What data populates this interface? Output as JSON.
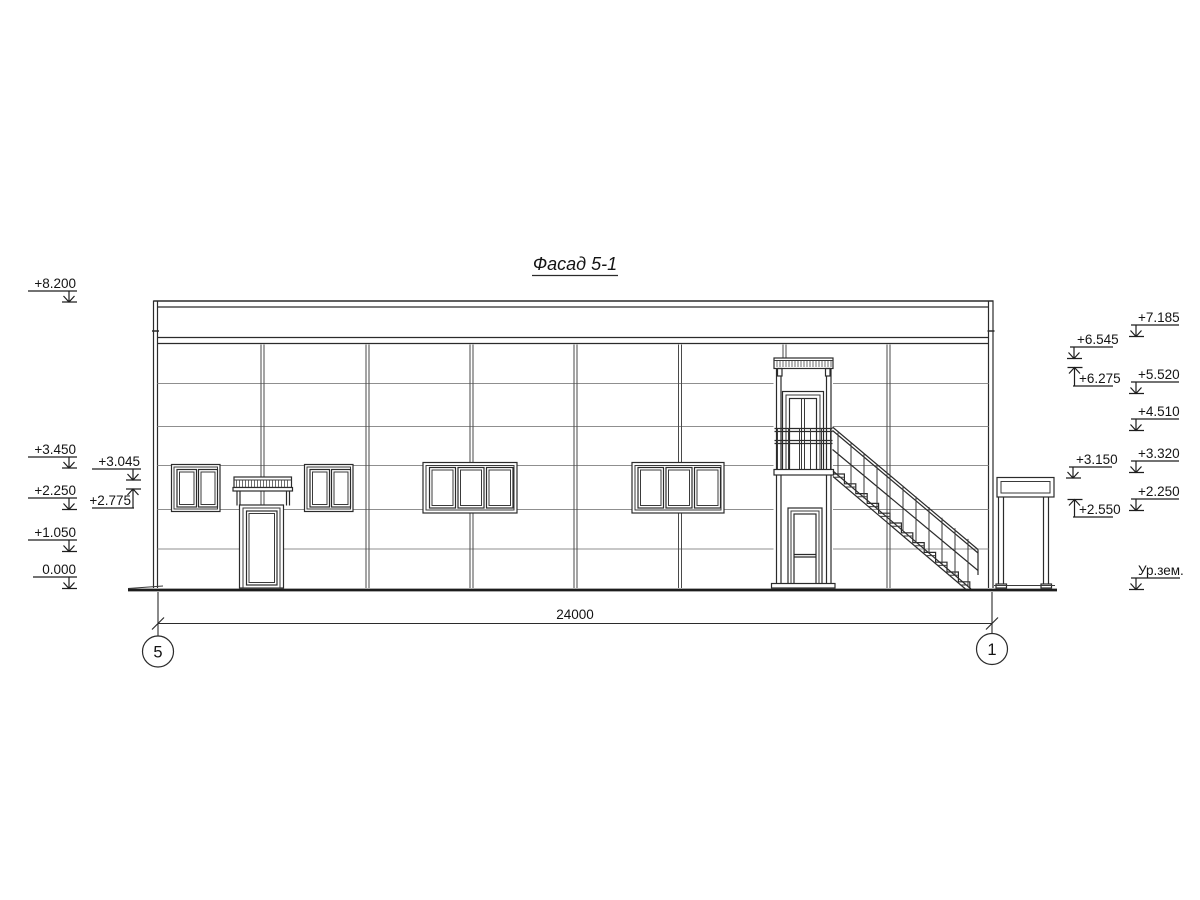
{
  "drawing": {
    "title": "Фасад 5-1",
    "dimension_total": "24000",
    "axis_left": "5",
    "axis_right": "1",
    "marks": {
      "left_outer": [
        "+8.200",
        "+3.450",
        "+2.250",
        "+1.050",
        "0.000"
      ],
      "left_inner": [
        "+3.045",
        "+2.775"
      ],
      "right_inner": [
        "+6.545",
        "+6.275",
        "+3.150",
        "+2.550"
      ],
      "right_outer": [
        "+7.185",
        "+5.520",
        "+4.510",
        "+3.320",
        "+2.250",
        "Ур.зем."
      ]
    },
    "colors": {
      "line": "#2b2b2b",
      "panel_joint": "#8f8f8f",
      "text": "#141414",
      "background": "#ffffff"
    }
  }
}
